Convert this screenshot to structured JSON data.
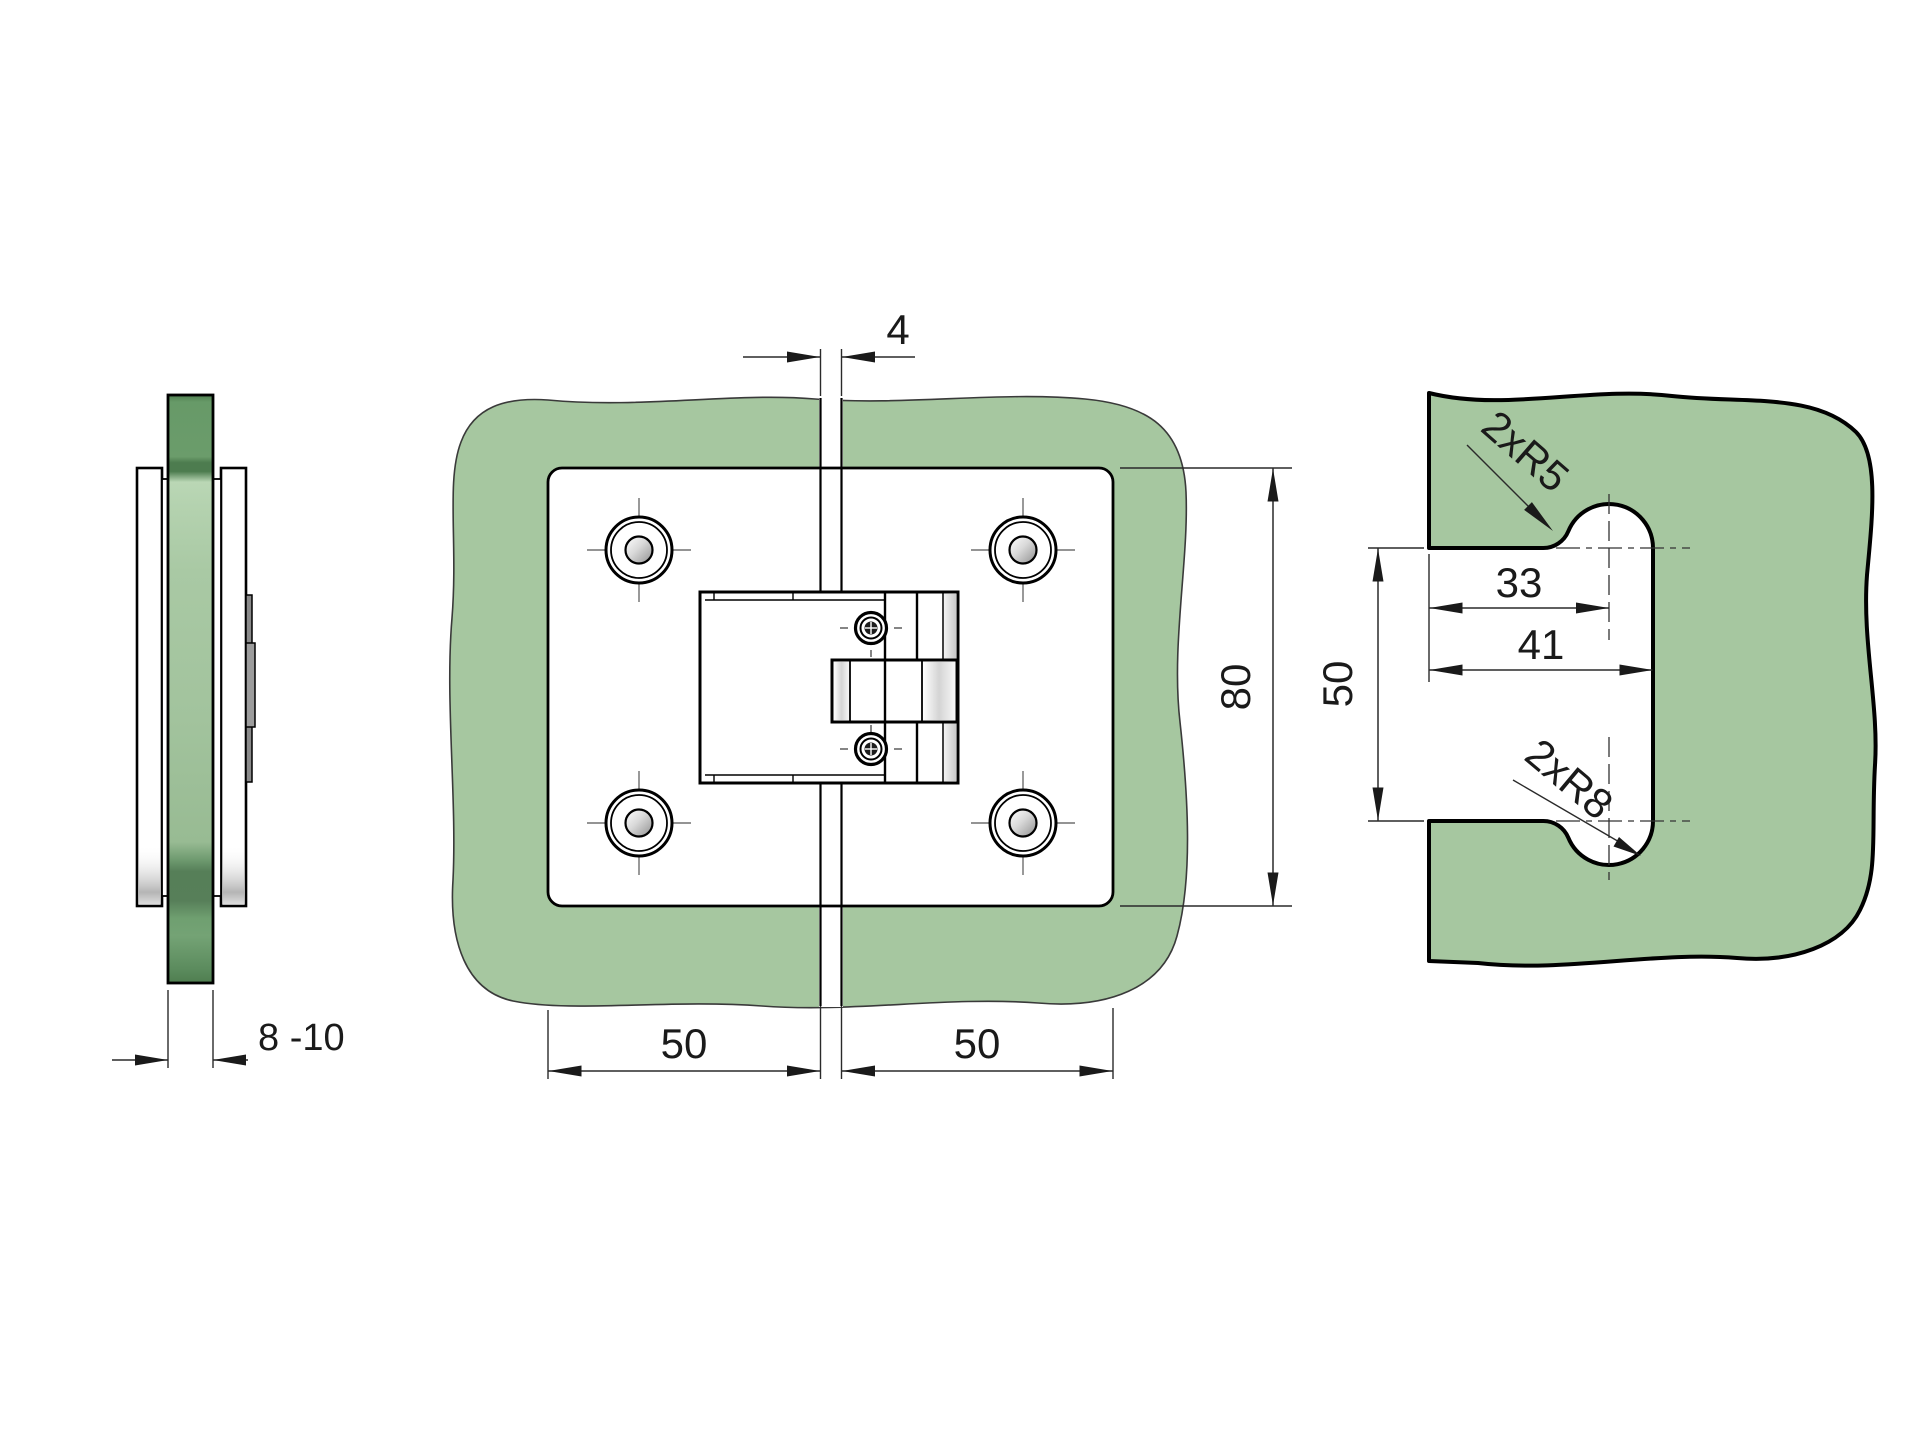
{
  "drawing": {
    "colors": {
      "glass": "#a6c7a0",
      "glass_light": "#b9d4b3",
      "glass_dark": "#55825b",
      "outline": "#1a1a1a"
    },
    "side_view": {
      "thickness": "8 -10"
    },
    "front_view": {
      "gap": "4",
      "height": "80",
      "left_width": "50",
      "right_width": "50"
    },
    "cutout_view": {
      "corner_radius": "2xR5",
      "center_offset": "33",
      "depth": "41",
      "height": "50",
      "bump_radius": "2xR8"
    }
  }
}
